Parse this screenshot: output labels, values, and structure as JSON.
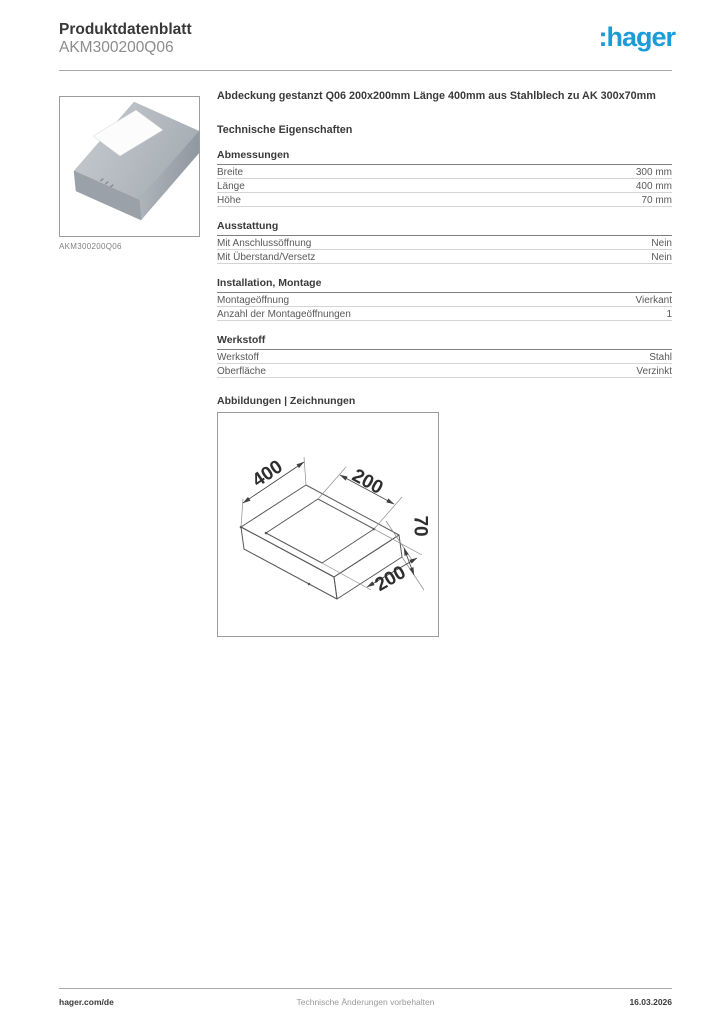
{
  "page": {
    "title": "Produktdatenblatt",
    "product_id": "AKM300200Q06"
  },
  "brand": {
    "logo_text": ":hager",
    "logo_color": "#1a9cd8"
  },
  "product_image": {
    "caption": "AKM300200Q06"
  },
  "description": "Abdeckung gestanzt Q06 200x200mm Länge 400mm aus Stahlblech zu AK 300x70mm",
  "tech": {
    "heading": "Technische Eigenschaften",
    "sections": [
      {
        "title": "Abmessungen",
        "rows": [
          {
            "label": "Breite",
            "value": "300 mm"
          },
          {
            "label": "Länge",
            "value": "400 mm"
          },
          {
            "label": "Höhe",
            "value": "70 mm"
          }
        ]
      },
      {
        "title": "Ausstattung",
        "rows": [
          {
            "label": "Mit Anschlussöffnung",
            "value": "Nein"
          },
          {
            "label": "Mit Überstand/Versetz",
            "value": "Nein"
          }
        ]
      },
      {
        "title": "Installation, Montage",
        "rows": [
          {
            "label": "Montageöffnung",
            "value": "Vierkant"
          },
          {
            "label": "Anzahl der Montageöffnungen",
            "value": "1"
          }
        ]
      },
      {
        "title": "Werkstoff",
        "rows": [
          {
            "label": "Werkstoff",
            "value": "Stahl"
          },
          {
            "label": "Oberfläche",
            "value": "Verzinkt"
          }
        ]
      }
    ]
  },
  "drawings": {
    "heading": "Abbildungen | Zeichnungen",
    "dimensions": {
      "length": "400",
      "hole_width": "200",
      "height": "70",
      "hole_length": "200"
    }
  },
  "footer": {
    "left": "hager.com/de",
    "center": "Technische Änderungen vorbehalten",
    "right": "16.03.2026"
  }
}
